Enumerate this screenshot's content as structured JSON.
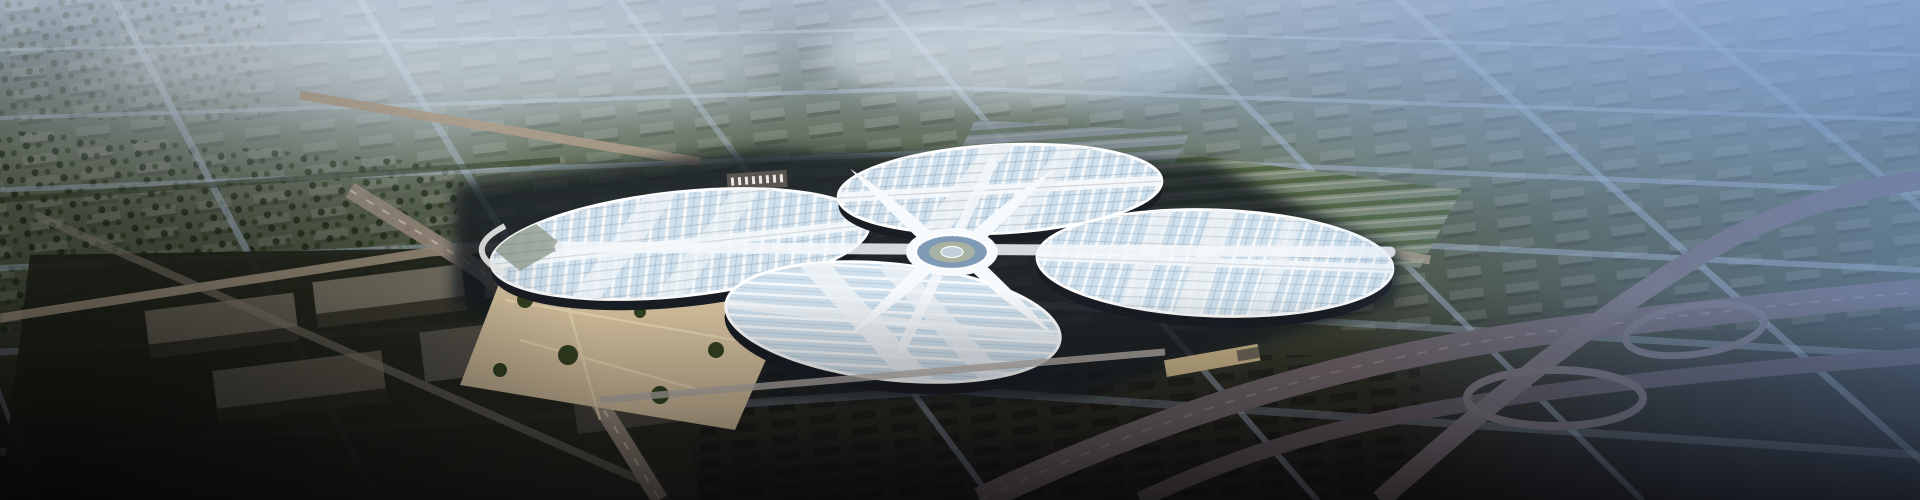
{
  "scene": {
    "type": "aerial-architectural-rendering",
    "subject": "four-leaf-clover exhibition and convention center",
    "description": "Hazy aerial rendering of a vast exhibition center shaped like a four-leaf clover with striped glass roofs and a white X-shaped central roof, surrounded by a blue-tinted city grid, tan plazas, dark warehouse blocks and a highway interchange",
    "time_of_day": "hazy daylight",
    "visible_text": []
  },
  "palette": {
    "haze_blue": "#6e95d0",
    "sky_white": "#dfe9f2",
    "city_top": "#76879c",
    "city_green": "#4b5340",
    "ground_dark": "#171614",
    "bottom_mauve": "#322c31",
    "roof_glass": "#cfe0ec",
    "roof_stripe": "#f4f8fb",
    "roof_white": "#f7fafc",
    "facade_dark": "#191d24",
    "plaza_tan": "#d5c19e",
    "road_tan": "#ae9f8c",
    "road_gray": "#a9bbcf",
    "tree_green": "#26351d",
    "highway_gray": "#6e6468",
    "hub_glass": "#7f9ab5",
    "court_green": "#a8b2a2"
  }
}
